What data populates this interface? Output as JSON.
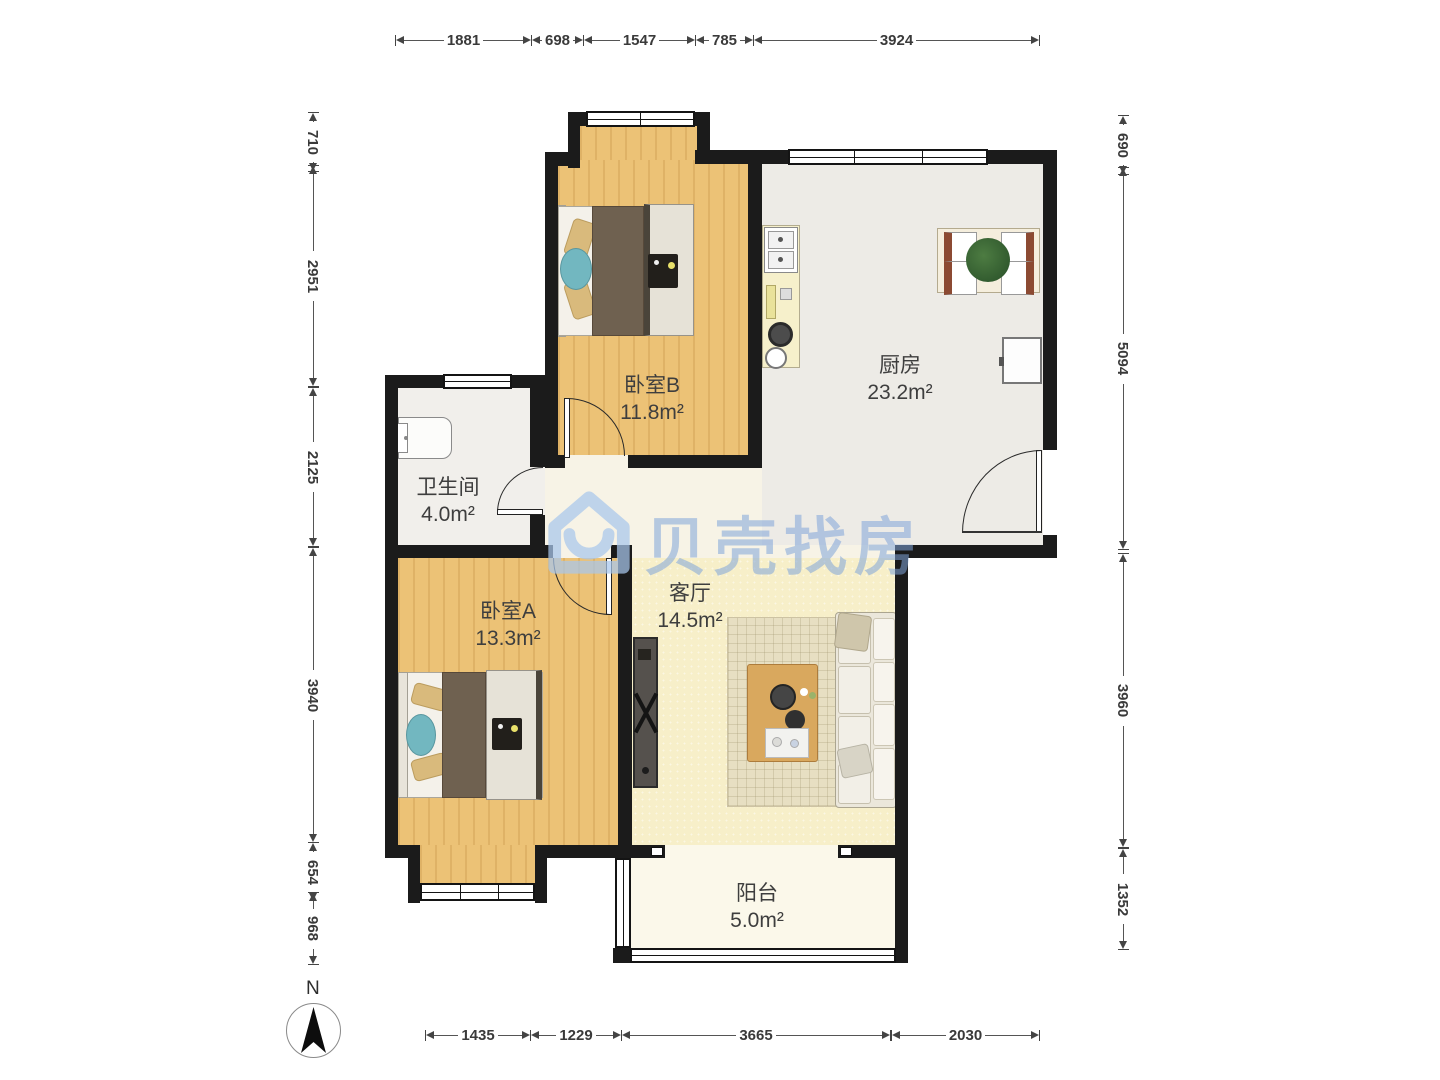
{
  "rooms": {
    "bedroom_b": {
      "name": "卧室B",
      "area": "11.8m²"
    },
    "kitchen": {
      "name": "厨房",
      "area": "23.2m²"
    },
    "bathroom": {
      "name": "卫生间",
      "area": "4.0m²"
    },
    "bedroom_a": {
      "name": "卧室A",
      "area": "13.3m²"
    },
    "living": {
      "name": "客厅",
      "area": "14.5m²"
    },
    "balcony": {
      "name": "阳台",
      "area": "5.0m²"
    }
  },
  "dimensions": {
    "top": [
      "1881",
      "698",
      "1547",
      "785",
      "3924"
    ],
    "left": [
      "710",
      "2951",
      "2125",
      "3940",
      "654",
      "968"
    ],
    "right": [
      "690",
      "5094",
      "3960",
      "1352"
    ],
    "bottom": [
      "1435",
      "1229",
      "3665",
      "2030"
    ]
  },
  "compass": {
    "label": "N"
  },
  "watermark": {
    "text": "贝壳找房"
  },
  "colors": {
    "wall": "#1b1b1b",
    "wood_floor": "#ecc276",
    "kitchen_floor": "#edebe6",
    "living_floor": "#f7efc9",
    "balcony_floor": "#fbf8ea",
    "watermark_blue": "#80a4d9"
  }
}
